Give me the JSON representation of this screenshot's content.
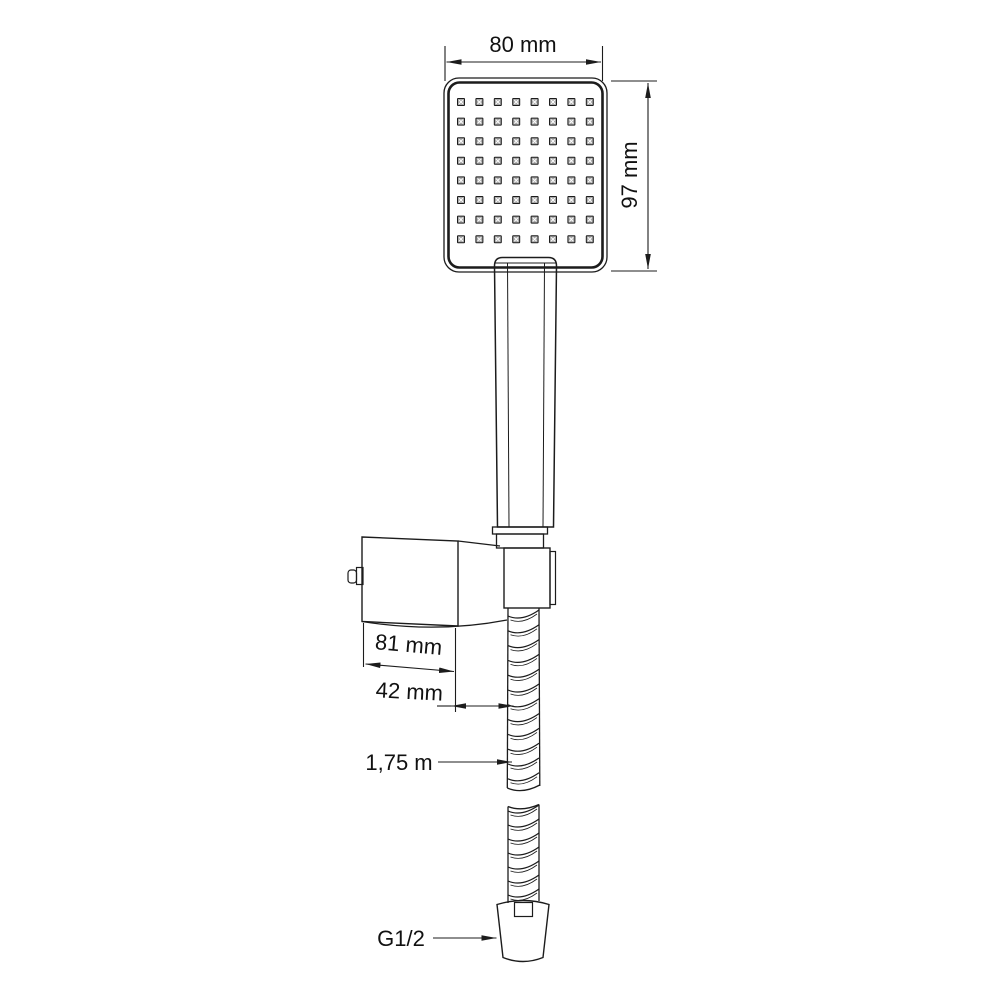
{
  "diagram": {
    "title": "Hand shower set dimensional drawing",
    "background": "#ffffff"
  },
  "colors": {
    "line": "#1c1c1c",
    "text": "#111111",
    "nozzle_fill": "#a9a9a9",
    "nozzle_cross": "#ffffff"
  },
  "dimensions": {
    "head_width": "80 mm",
    "head_height": "97 mm",
    "bracket_width": "81 mm",
    "bracket_offset": "42 mm",
    "hose_length": "1,75 m",
    "thread_size": "G1/2"
  },
  "shower_head": {
    "nozzle_rows": 8,
    "nozzle_cols": 8
  },
  "hose": {
    "upper_rings": 12,
    "lower_rings": 7
  }
}
